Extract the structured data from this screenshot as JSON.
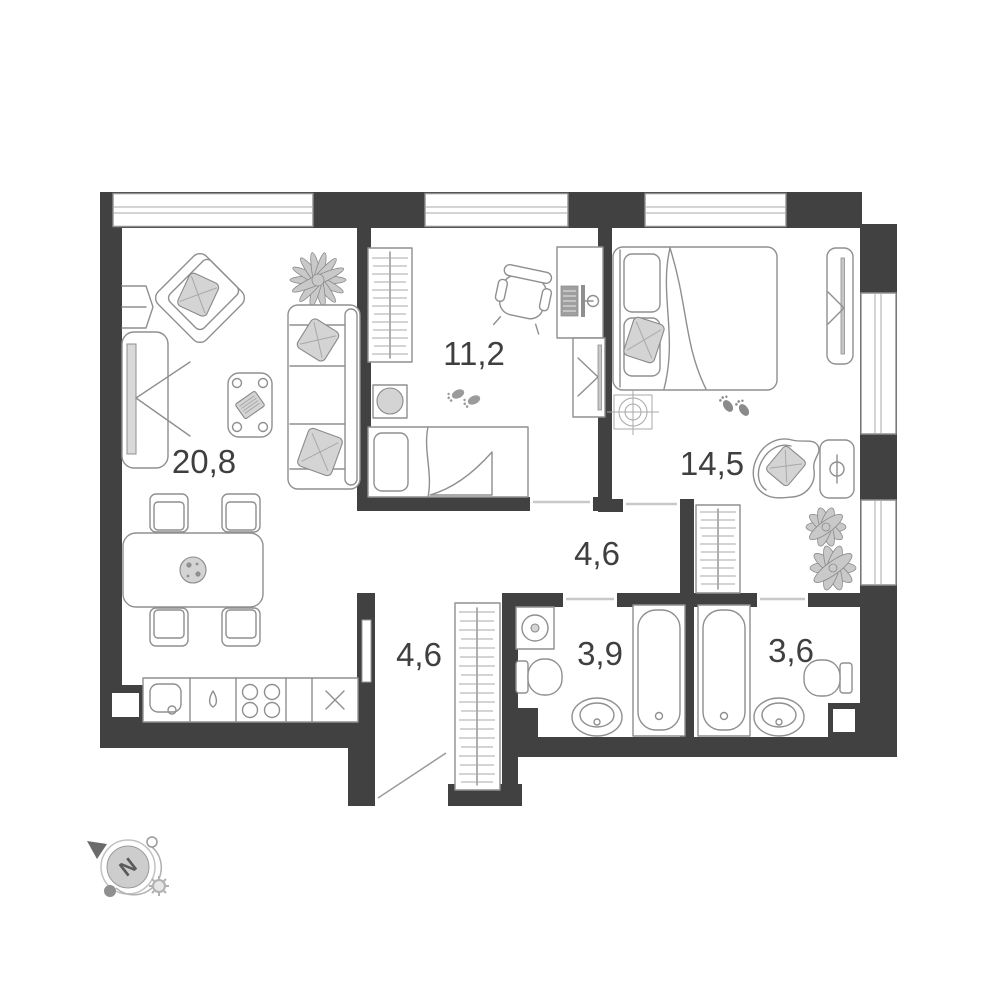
{
  "plan": {
    "type": "apartment-floor-plan",
    "wall_color": "#414141",
    "furniture_stroke": "#8f8f8f",
    "accent_fill": "#d4d4d4",
    "label_color": "#3f3f3f",
    "background": "#ffffff"
  },
  "rooms": {
    "living_kitchen": {
      "area": "20,8",
      "furniture": [
        "armchair-icon",
        "plant-icon",
        "sofa-icon",
        "tv-console-icon",
        "coffee-table-icon",
        "dining-table-icon",
        "chair-icon",
        "kitchen-sink-icon",
        "dishwasher-icon",
        "stove-icon",
        "fridge-icon"
      ]
    },
    "bedroom_small": {
      "area": "11,2",
      "furniture": [
        "wardrobe-icon",
        "desk-icon",
        "computer-icon",
        "office-chair-icon",
        "mirror-icon",
        "stool-icon",
        "single-bed-icon",
        "footprints-icon"
      ]
    },
    "bedroom_master": {
      "area": "14,5",
      "furniture": [
        "double-bed-icon",
        "ceiling-light-icon",
        "mirror-icon",
        "armchair-icon",
        "side-table-lamp-icon",
        "wardrobe-icon",
        "plant-icon",
        "footprints-icon"
      ]
    },
    "corridor": {
      "area": "4,6"
    },
    "hall": {
      "area": "4,6",
      "furniture": [
        "wardrobe-icon",
        "entry-door-icon",
        "pocket-door-icon"
      ]
    },
    "bathroom": {
      "area": "3,9",
      "furniture": [
        "washing-machine-icon",
        "toilet-icon",
        "washbasin-icon",
        "bathtub-icon"
      ]
    },
    "bathroom_master": {
      "area": "3,6",
      "furniture": [
        "bathtub-icon",
        "toilet-icon",
        "washbasin-icon"
      ]
    }
  },
  "windows": {
    "top_wall": 3,
    "right_wall": 2
  },
  "compass": {
    "north_label": "N"
  }
}
